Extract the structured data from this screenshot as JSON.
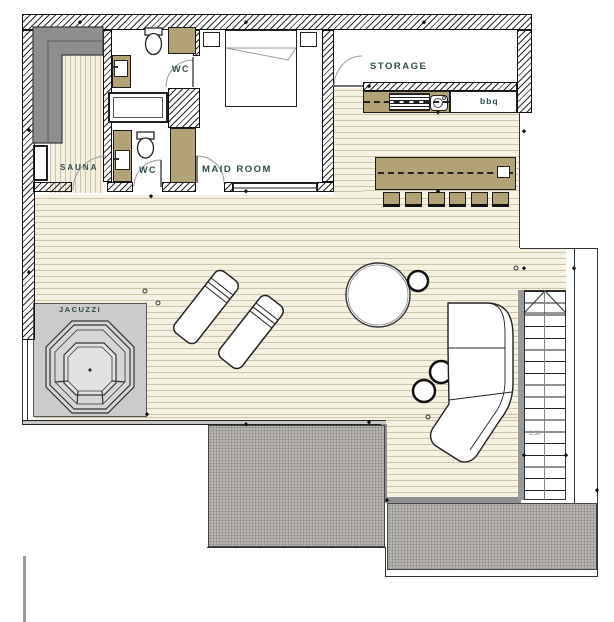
{
  "plan_title": "terrace-floor-plan",
  "labels": {
    "sauna": "SAUNA",
    "wc_upper": "WC",
    "wc_lower": "WC",
    "maid_room": "MAID ROOM",
    "storage": "STORAGE",
    "bbq": "bbq",
    "jacuzzi": "JACUZZI",
    "stair_dimension": "1.50"
  },
  "colors": {
    "wood_tan": "#b3a273",
    "deck_base": "#f6f2e2",
    "deck_plank_line": "#ccc5a8",
    "gravel_gray": "#b6b3af",
    "jacuzzi_area_gray": "#cbcbcb",
    "sauna_bench_gray": "#8e8e8e",
    "wall_hatch": "#2b2b2b",
    "label_text": "#2f4c4c"
  },
  "features": [
    "sauna with L-shaped bench and heater",
    "two WC rooms with toilet, vanity and bathtub",
    "maid room with double bed and nightstands",
    "storage room",
    "bbq counter with grill and sink",
    "dining table with six chairs",
    "wood deck terrace",
    "jacuzzi on gray pad",
    "two lounge chairs",
    "round daybed with side table",
    "curved sectional sofa with side tables",
    "staircase",
    "gravel border"
  ]
}
